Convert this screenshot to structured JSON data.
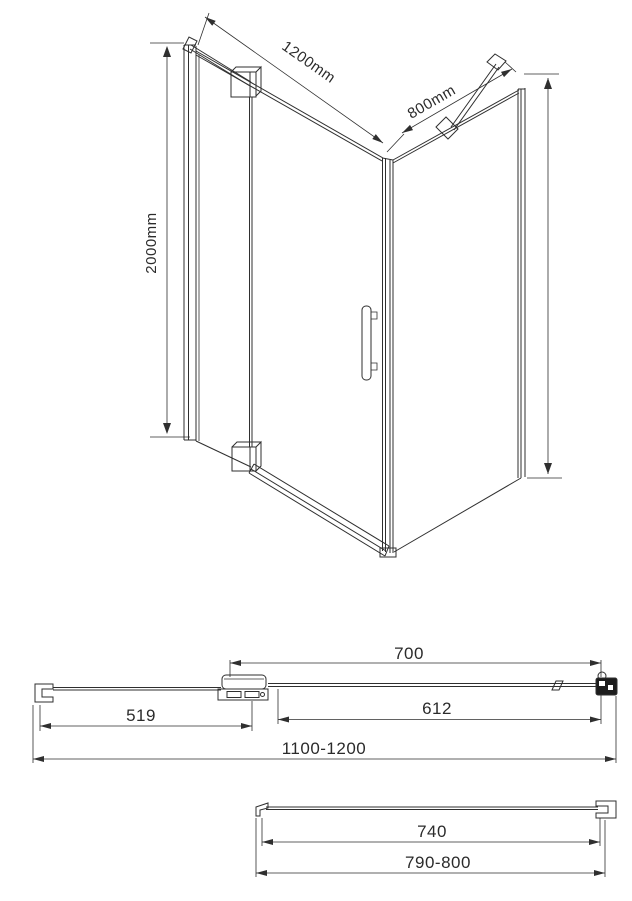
{
  "title": "Shower enclosure dimensional drawing",
  "colors": {
    "line": "#2f2f2f",
    "text": "#2b2b2b",
    "dark_fill": "#1c1c1c",
    "background": "#ffffff"
  },
  "isometric_view": {
    "width_label": "1200mm",
    "depth_label": "800mm",
    "height_label": "2000mm"
  },
  "door_plan_view": {
    "opening_width_label": "700",
    "fixed_segment_label": "519",
    "door_segment_label": "612",
    "total_width_label": "1100-1200"
  },
  "side_panel_plan_view": {
    "glass_width_label": "740",
    "total_depth_label": "790-800"
  }
}
